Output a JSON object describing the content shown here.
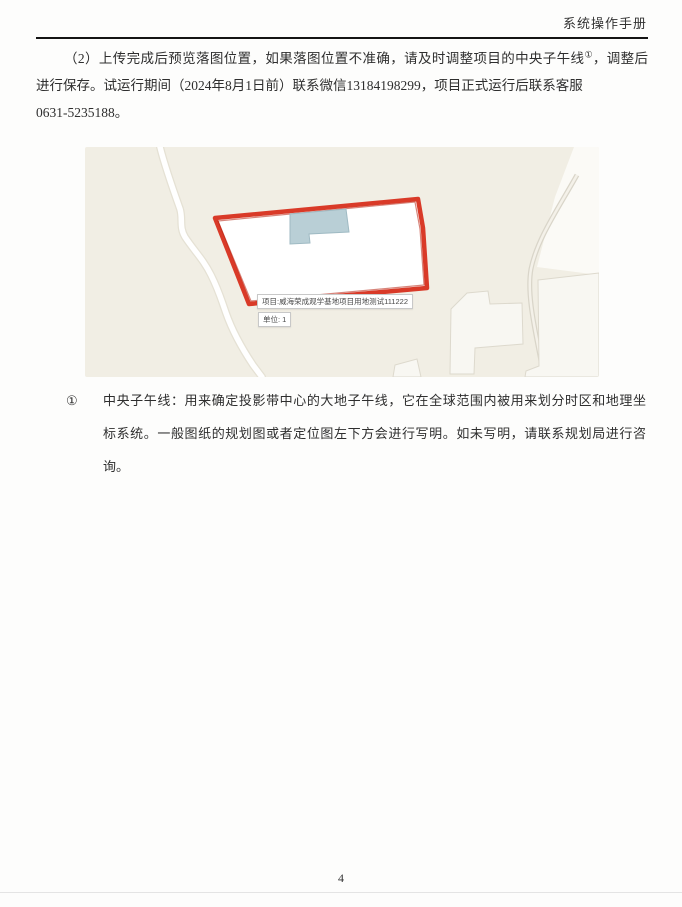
{
  "colors": {
    "ink": "#2e2e2e",
    "header_rule": "#141414",
    "map_bg": "#f1eee4",
    "map_white_area": "#fbfaf6",
    "road_fill": "#ffffff",
    "road_casing": "#e5e1d4",
    "thin_road_casing": "#d9d5c9",
    "thin_road_fill": "#f4f1e9",
    "building_fill": "#f8f7f2",
    "building_stroke": "#ddd9cd",
    "parcel_red": "#d93a28",
    "parcel_red_dark": "#b7200f",
    "building_blue": "#b9cfd6",
    "building_blue_stroke": "#9fbac3",
    "tooltip_border": "#c8c8c8",
    "tooltip_text": "#4a4a4a",
    "footer_rule": "#e4e4e4"
  },
  "header": {
    "title": "系统操作手册"
  },
  "paragraph": {
    "line1_pre": "（2）上传完成后预览落图位置，如果落图位置不准确，请及时调整项目的中央子午线",
    "line1_sup": "①",
    "line1_post": "，调整后",
    "line2": "进行保存。试运行期间（2024年8月1日前）联系微信13184198299，项目正式运行后联系客服",
    "line3": "0631-5235188。"
  },
  "map": {
    "tooltips": {
      "project": "项目:威海荣成观学基地项目用地测试111222",
      "unit": "单位: 1"
    }
  },
  "footnote": {
    "marker": "①",
    "lines": [
      "中央子午线：用来确定投影带中心的大地子午线，它在全球范围内被用来划分时区和地理坐",
      "标系统。一般图纸的规划图或者定位图左下方会进行写明。如未写明，请联系规划局进行咨",
      "询。"
    ]
  },
  "footer": {
    "page_number": "4"
  }
}
